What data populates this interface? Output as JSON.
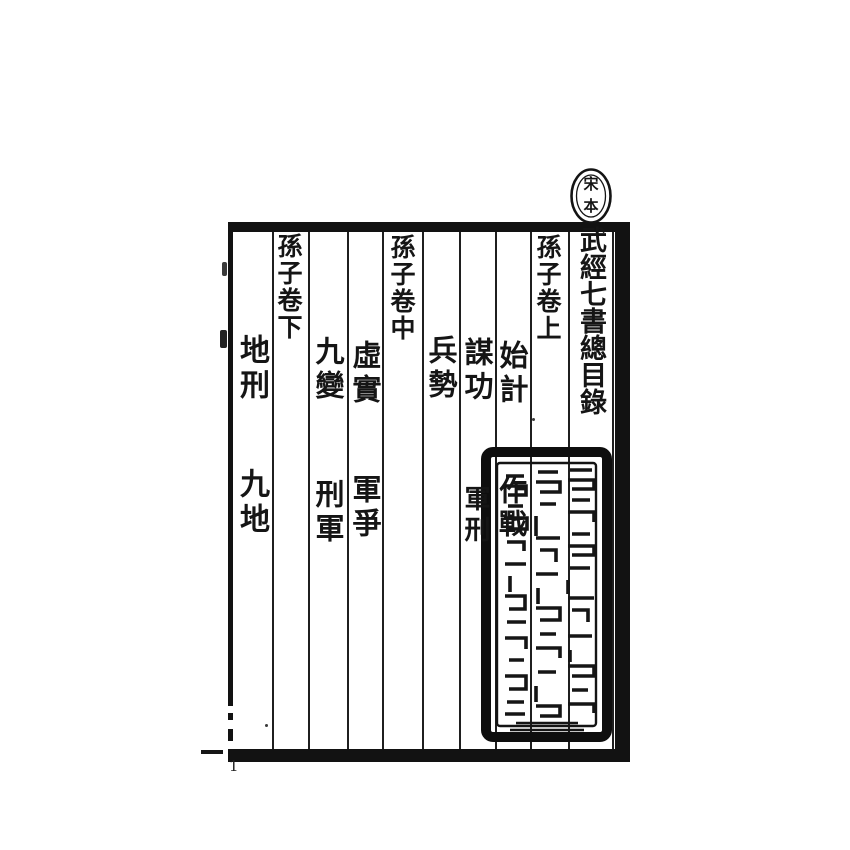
{
  "page": {
    "paper_color": "#ffffff",
    "ink_color": "#141414",
    "page_number": "1"
  },
  "edition_seal": {
    "shape": "oval",
    "top_char": "宋",
    "bottom_char": "本"
  },
  "toc": {
    "title": "武經七書總目錄",
    "vol_shang": {
      "heading": "孫子卷上",
      "entry_shiji": "始計",
      "entry_mougong": "謀功",
      "entry_bingshi": "兵勢",
      "entry_zuozhan": "作戰",
      "entry_junxing": "軍刑"
    },
    "vol_zhong": {
      "heading": "孫子卷中",
      "entry_xushi": "虛實",
      "entry_jiubian": "九變",
      "entry_junzheng": "軍爭",
      "entry_xingjun": "刑軍"
    },
    "vol_xia": {
      "heading": "孫子卷下",
      "entry_dixing": "地刑",
      "entry_jiudi": "九地"
    }
  },
  "collector_seal": {
    "shape": "rectangle",
    "script": "illegible archaic seal script"
  }
}
